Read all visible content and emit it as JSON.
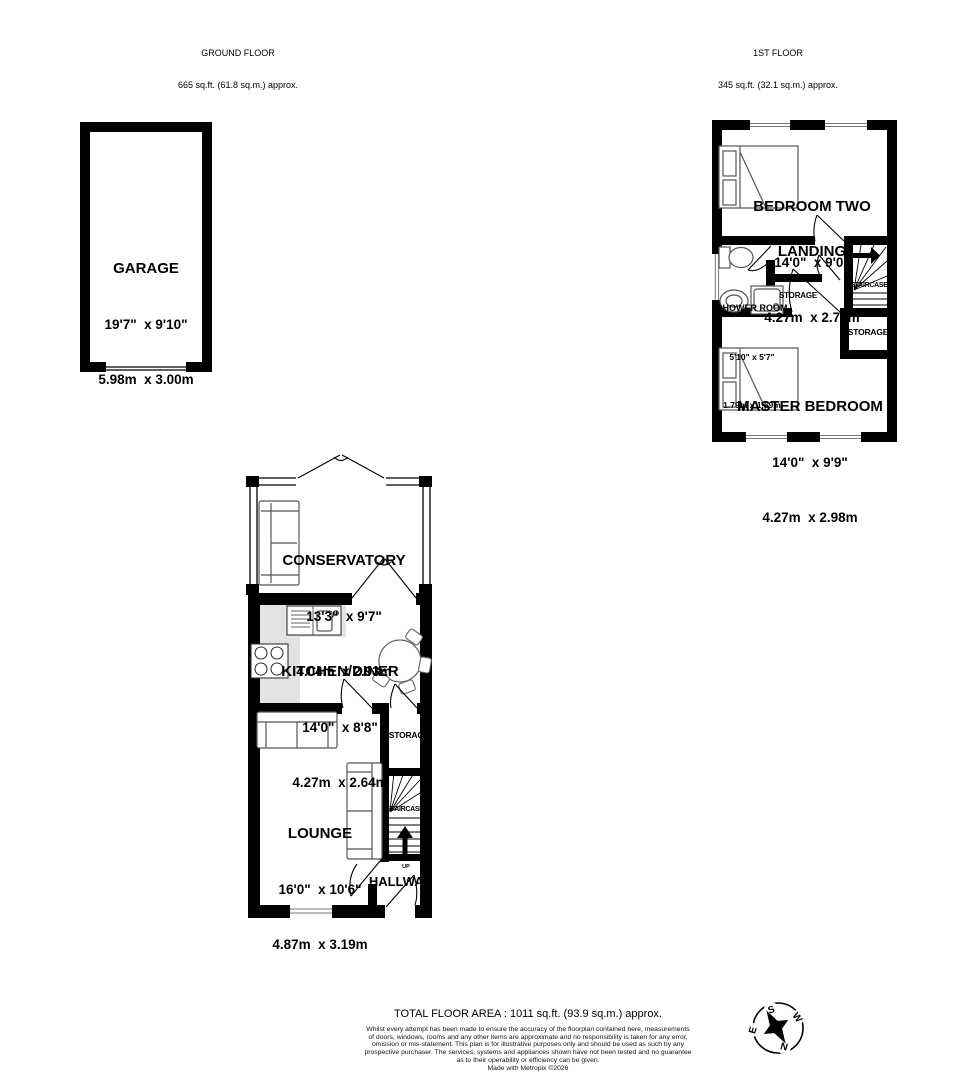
{
  "headers": {
    "ground": {
      "title": "GROUND FLOOR",
      "area": "665 sq.ft. (61.8 sq.m.) approx."
    },
    "first": {
      "title": "1ST FLOOR",
      "area": "345 sq.ft. (32.1 sq.m.) approx."
    }
  },
  "rooms": {
    "garage": {
      "name": "GARAGE",
      "imperial": "19'7\"  x 9'10\"",
      "metric": "5.98m  x 3.00m"
    },
    "bedroom_two": {
      "name": "BEDROOM TWO",
      "imperial": "14'0\"  x 9'0\"",
      "metric": "4.27m  x 2.74m"
    },
    "landing": {
      "name": "LANDING"
    },
    "shower_room": {
      "name": "SHOWER ROOM",
      "imperial": "5'10\" x 5'7\"",
      "metric": "1.79m x 1.69m"
    },
    "storage_first_mid": {
      "name": "STORAGE"
    },
    "storage_first_right": {
      "name": "STORAGE"
    },
    "staircase_first": {
      "name": "STAIRCASE"
    },
    "master_bedroom": {
      "name": "MASTER BEDROOM",
      "imperial": "14'0\"  x 9'9\"",
      "metric": "4.27m  x 2.98m"
    },
    "conservatory": {
      "name": "CONSERVATORY",
      "imperial": "13'3\"  x 9'7\"",
      "metric": "4.04m  x 2.93m"
    },
    "kitchen_diner": {
      "name": "KITCHEN/DINER",
      "imperial": "14'0\"  x 8'8\"",
      "metric": "4.27m  x 2.64m"
    },
    "storage_ground": {
      "name": "STORAGE"
    },
    "lounge": {
      "name": "LOUNGE",
      "imperial": "16'0\"  x 10'6\"",
      "metric": "4.87m  x 3.19m"
    },
    "staircase_ground": {
      "name": "STAIRCASE"
    },
    "hallway": {
      "name": "HALLWAY"
    }
  },
  "labels": {
    "up": "UP"
  },
  "footer": {
    "total": "TOTAL FLOOR AREA : 1011 sq.ft. (93.9 sq.m.) approx.",
    "disclaimer_lines": [
      "Whilst every attempt has been made to ensure the accuracy of the floorplan contained here, measurements",
      "of doors, windows, rooms and any other items are approximate and no responsibility is taken for any error,",
      "omission or mis-statement. This plan is for illustrative purposes only and should be used as such by any",
      "prospective purchaser. The services, systems and appliances shown have not been tested and no guarantee",
      "as to their operability or efficiency can be given.",
      "Made with Metropix ©2026"
    ]
  },
  "compass": {
    "n": "N",
    "s": "S",
    "e": "E",
    "w": "W"
  },
  "colors": {
    "wall": "#000000",
    "counter": "#e3e3e3",
    "fixture_outline": "#666666"
  }
}
